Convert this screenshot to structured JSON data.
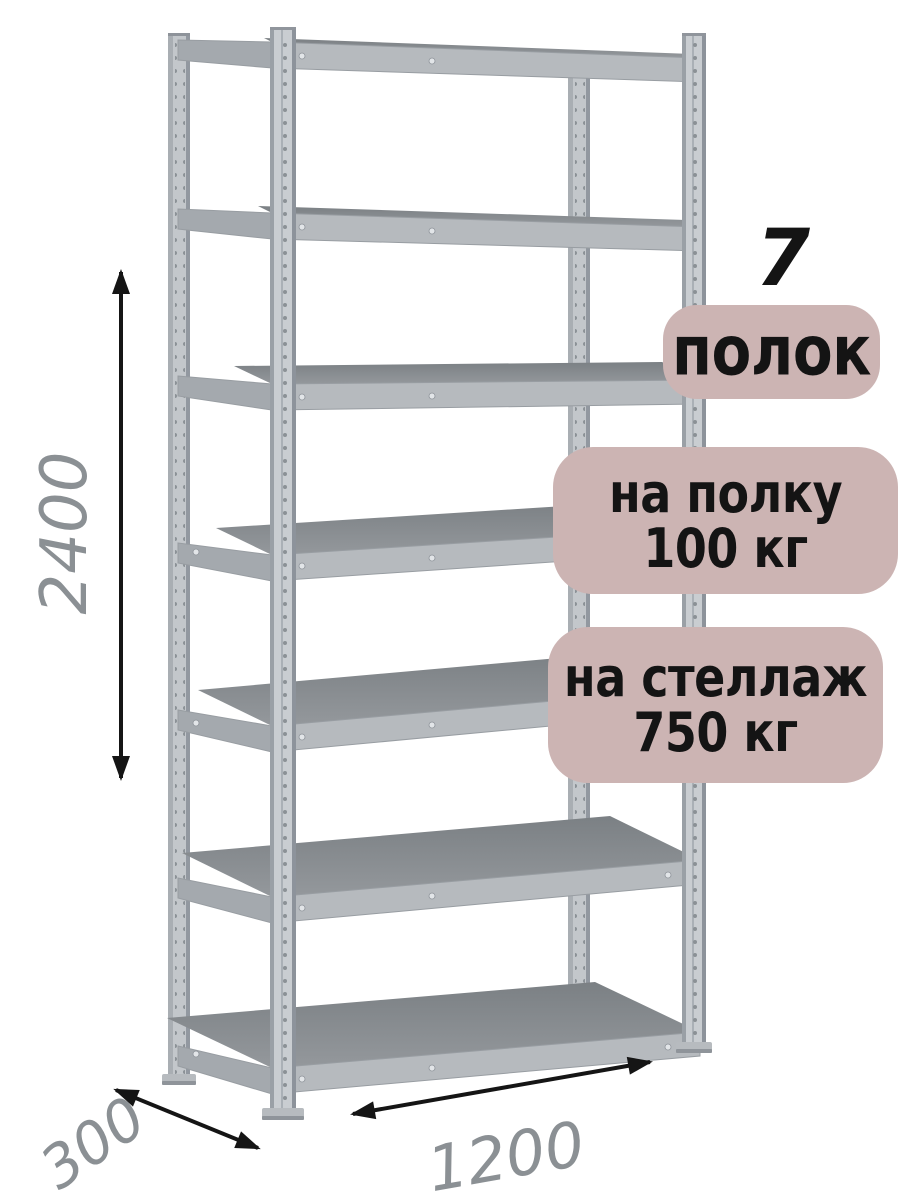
{
  "badges": {
    "shelf_count_number": "7",
    "shelf_count_label": "полок",
    "per_shelf_load": {
      "line1": "на полку",
      "line2": "100 кг"
    },
    "per_rack_load": {
      "line1": "на стеллаж",
      "line2": "750 кг"
    }
  },
  "dimensions": {
    "height_mm": "2400",
    "depth_mm": "300",
    "width_mm": "1200"
  },
  "colors": {
    "badge_bg": "#ccb4b3",
    "badge_text": "#141414",
    "dim_text": "#8b9094",
    "arrow": "#151515",
    "metal_light": "#c9cdd1",
    "metal_mid": "#b6babe",
    "metal_dark": "#8d9195"
  }
}
